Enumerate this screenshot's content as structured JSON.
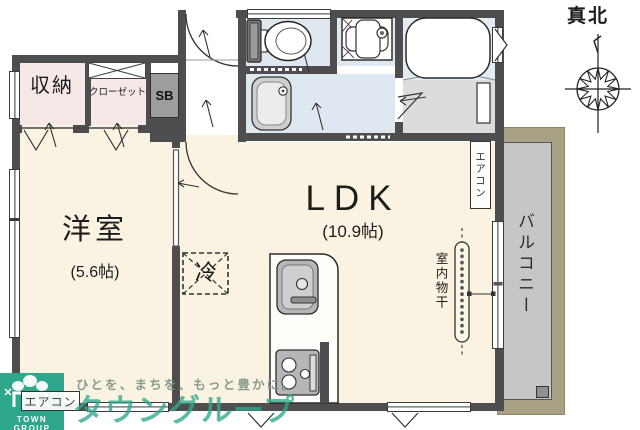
{
  "plan": {
    "compass_label": "真北",
    "storage": "収納",
    "closet": "クローゼット",
    "shoe_box": "SB",
    "western_room": "洋室",
    "western_room_size": "(5.6帖)",
    "ldk": "LDK",
    "ldk_size": "(10.9帖)",
    "refrigerator": "冷",
    "balcony": "バルコニー",
    "aircon_right": "エアコン",
    "aircon_bottom": "エアコン",
    "indoor_drying": "室内物干"
  },
  "branding": {
    "logo_text": "TOWN GROUP",
    "tagline": "ひとを、まちを、もっと豊かに。",
    "company_watermark": "タウングループ"
  },
  "colors": {
    "room_floor": "#fbf3e2",
    "closet_floor": "#f6e8e7",
    "wet_area_floor": "#dfe8f1",
    "bath_floor": "#dcdcdc",
    "balcony_deck": "#c6c6c8",
    "balcony_frame": "#a9a186",
    "wall": "#4e4e50",
    "brand_teal": "#2fa78c"
  }
}
